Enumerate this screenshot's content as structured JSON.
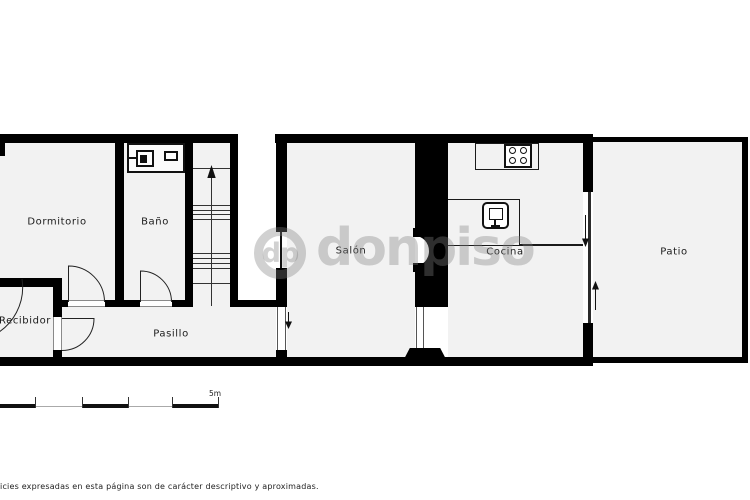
{
  "floorplan": {
    "rooms": {
      "dormitorio": "Dormitorio",
      "bano": "Baño",
      "salon": "Salón",
      "cocina": "Cocina",
      "patio": "Patio",
      "recibidor": "Recibidor",
      "pasillo": "Pasillo"
    },
    "watermark": {
      "logo": "dp",
      "name": "donpiso",
      "color": "#808080"
    },
    "scale": {
      "label": "5m"
    },
    "disclaimer": "ficies expresadas en esta página son de carácter descriptivo y aproximadas.",
    "colors": {
      "wall": "#000000",
      "room_fill": "#f2f2f2"
    },
    "icons": {
      "stove": "stove-burners-icon",
      "sink": "kitchen-sink-icon",
      "bath": "bath-fixtures-icon",
      "stairs": "stairs-up-arrow-icon",
      "doors": "door-swing-arc"
    }
  }
}
